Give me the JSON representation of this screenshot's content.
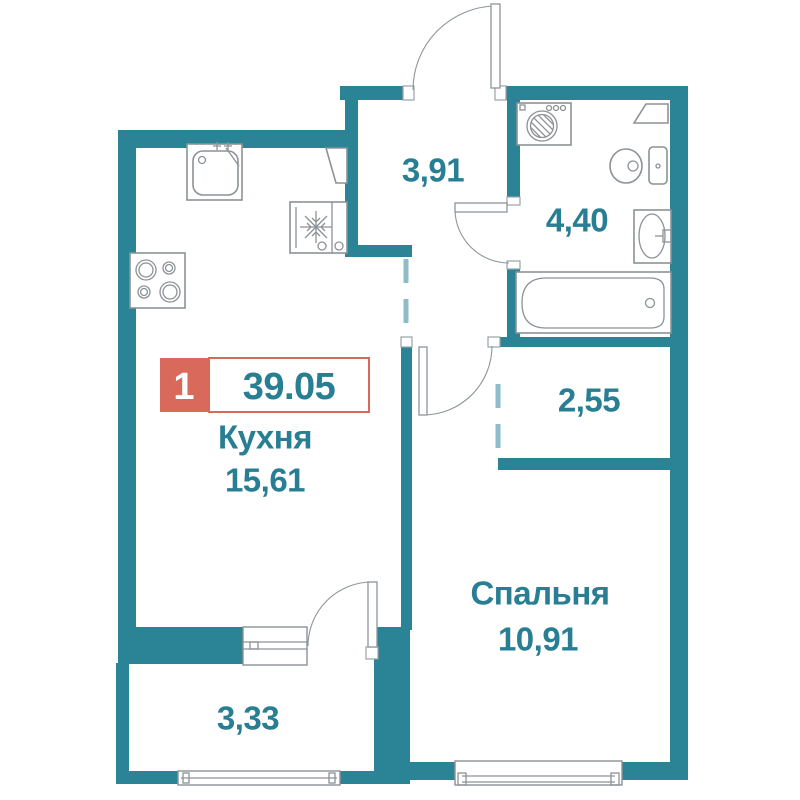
{
  "colors": {
    "wall": "#2B8396",
    "label": "#287E93",
    "dashed": "#8FBCCA",
    "red": "#D9695A",
    "fixture": "#8C9296",
    "bg": "#FFFFFF"
  },
  "plan": {
    "badge": {
      "room_count": "1",
      "total_area": "39.05"
    },
    "rooms": {
      "kitchen": {
        "name": "Кухня",
        "area": "15,61"
      },
      "hallway": {
        "area": "3,91"
      },
      "bathroom": {
        "area": "4,40"
      },
      "closet": {
        "area": "2,55"
      },
      "bedroom": {
        "name": "Спальня",
        "area": "10,91"
      },
      "balcony": {
        "area": "3,33"
      }
    },
    "fixtures": [
      "kitchen-sink",
      "stove",
      "fridge",
      "kitchen-cabinet",
      "washing-machine",
      "corner-shelf",
      "toilet",
      "bathroom-sink",
      "bathtub",
      "entrance-door",
      "bathroom-door",
      "bedroom-door",
      "balcony-door",
      "kitchen-balcony-window",
      "balcony-glazing",
      "bedroom-window"
    ]
  }
}
